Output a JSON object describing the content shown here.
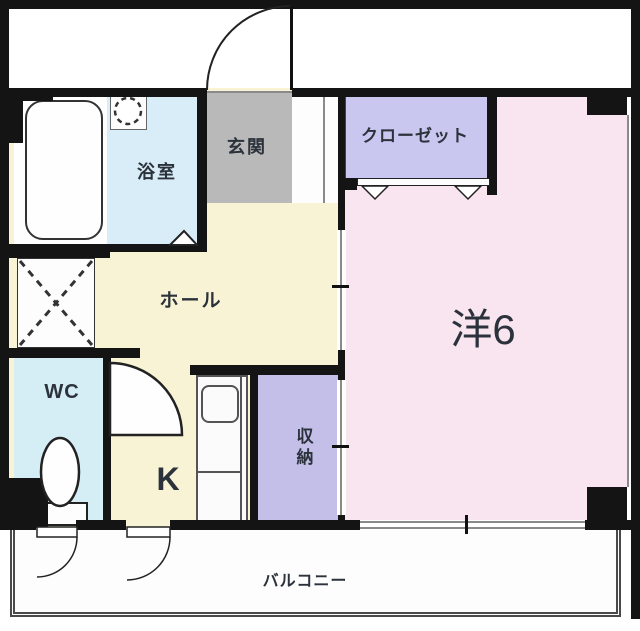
{
  "floorplan": {
    "title": "1K apartment floor plan",
    "rooms": {
      "bathroom": {
        "label": "浴室"
      },
      "entrance": {
        "label": "玄関"
      },
      "closet": {
        "label": "クローゼット"
      },
      "western_room": {
        "label": "洋6"
      },
      "hall": {
        "label": "ホール"
      },
      "wc": {
        "label": "WC"
      },
      "kitchen": {
        "label": "K"
      },
      "storage": {
        "label": "収納"
      },
      "balcony": {
        "label": "バルコニー"
      }
    },
    "fixtures": {
      "bathtub": "bathtub",
      "washbasin": "washbasin",
      "toilet": "toilet",
      "kitchen_counter": "kitchen-counter-with-sink",
      "washer_space": "washing-machine-space"
    },
    "colors": {
      "wall_black": "#141414",
      "line_gray": "#8a8a8a",
      "room_pink": "#f9e5ef",
      "hall_cream": "#f8f3d4",
      "water_blue": "#d8edf8",
      "wc_blue": "#d5edf4",
      "closet_purple": "#c9c7ef",
      "storage_purple": "#c3bfe8",
      "entrance_gray": "#b9b9b9"
    }
  }
}
